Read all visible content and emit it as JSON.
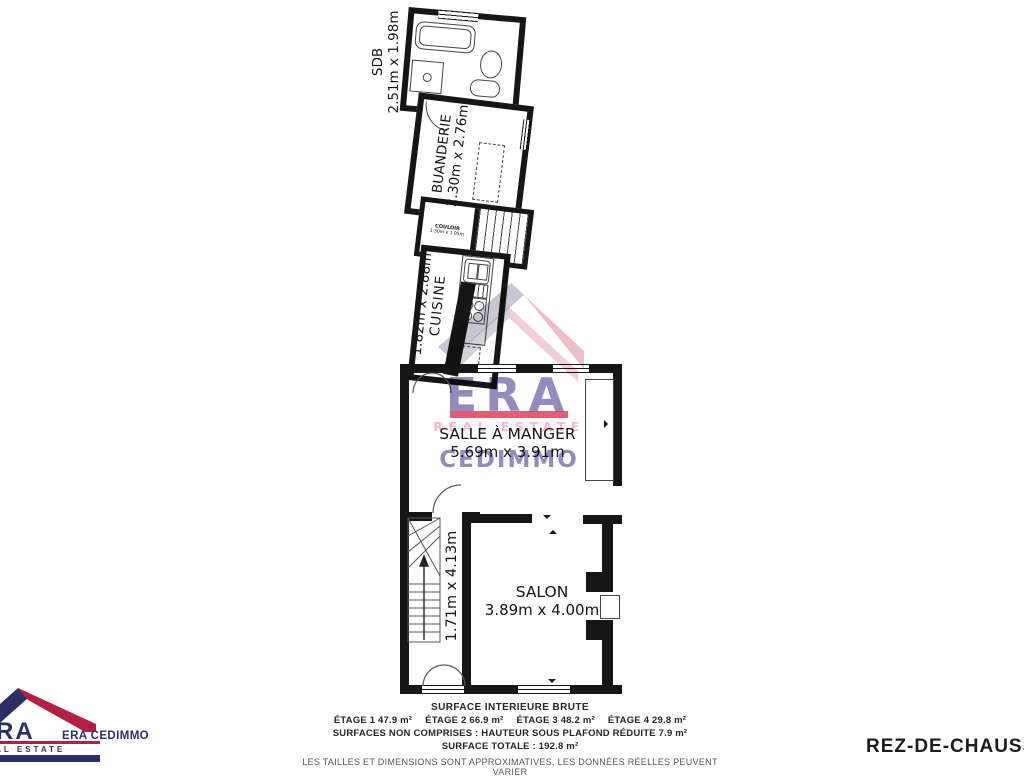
{
  "floor_label": "REZ-DE-CHAUSSÉE",
  "rooms": {
    "sdb": {
      "name": "SDB",
      "dims": "2.51m x 1.98m"
    },
    "buanderie": {
      "name": "BUANDERIE",
      "dims": "2.30m x 2.76m"
    },
    "couloir": {
      "name": "COULOIR",
      "dims": "1.30m x 1.05m"
    },
    "cuisine": {
      "name": "CUISINE",
      "dims": "1.82m x 2.88m"
    },
    "salle_a_manger": {
      "name": "SALLE À MANGER",
      "dims": "5.69m x 3.91m"
    },
    "escalier": {
      "dims": "1.71m x 4.13m"
    },
    "salon": {
      "name": "SALON",
      "dims": "3.89m x 4.00m"
    }
  },
  "watermark": {
    "era": "ERA",
    "real_estate": "REAL ESTATE",
    "cedimmo": "CEDIMMO"
  },
  "logo": {
    "era": "ERA",
    "real_estate": "REAL ESTATE",
    "company": "ERA CEDIMMO"
  },
  "footer": {
    "title": "SURFACE INTERIEURE BRUTE",
    "etages": [
      {
        "label": "ÉTAGE 1",
        "area": "47.9 m²"
      },
      {
        "label": "ÉTAGE 2",
        "area": "66.9 m²"
      },
      {
        "label": "ÉTAGE 3",
        "area": "48.2 m²"
      },
      {
        "label": "ÉTAGE 4",
        "area": "29.8 m²"
      }
    ],
    "non_comprises": "SURFACES NON COMPRISES :  HAUTEUR SOUS PLAFOND RÉDUITE 7.9 m²",
    "total": "SURFACE TOTALE :  192.8 m²",
    "disclaimer": "LES TAILLES ET DIMENSIONS SONT APPROXIMATIVES, LES DONNÉES RÉELLES PEUVENT VARIER"
  },
  "colors": {
    "wall": "#161616",
    "stroke": "#444444",
    "label": "#141414",
    "wm_purple": "#8c85bb",
    "wm_red": "#e0506a",
    "wm_pink": "#f2bac8",
    "roof_navy": "#343264",
    "roof_red": "#c2244c",
    "logo_navy": "#2b2f66",
    "logo_red": "#b41f44",
    "footer_dark": "#262626",
    "footer_gray": "#575757"
  }
}
